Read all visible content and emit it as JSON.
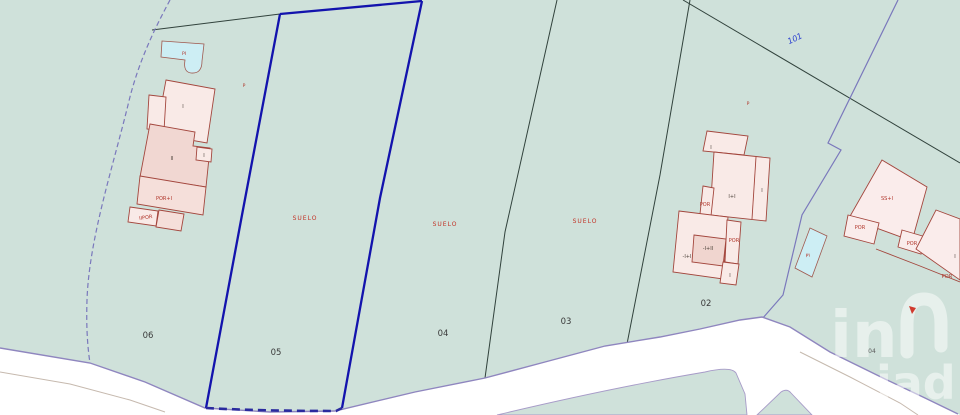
{
  "map": {
    "parcels": [
      "06",
      "05",
      "04",
      "03",
      "02"
    ],
    "suelo": [
      "SUELO",
      "SUELO",
      "SUELO"
    ],
    "road_ref": "101",
    "adjacent_parcel_ref": "04",
    "markers": {
      "p_left": "P",
      "p_right": "P",
      "pool_left": "PI",
      "pool_right": "PI"
    },
    "building_left": {
      "floor_i": "I",
      "floor_ii": "II",
      "annex_i": "I",
      "por_i": "POR+I",
      "iipor": "IIPOR"
    },
    "building_center": {
      "top_i": "I",
      "i_plus_i": "I+I",
      "right_i": "I",
      "por_left": "POR",
      "minus_i_plus_ii": "-I+II",
      "por_right": "POR",
      "minus_i_plus_i": "-I+I",
      "bottom_i": "I"
    },
    "building_right": {
      "ss_i": "SS+I",
      "por_a": "POR",
      "por_b": "POR",
      "part_i": "I",
      "por_c": "POR"
    },
    "watermark": {
      "logo": "in",
      "text": "iad"
    },
    "colors": {
      "background": "#cfe1da",
      "highlight_blue": "#1313ad",
      "building_fill": "#f9eae7",
      "building_fill_dark": "#f1d7d2",
      "building_stroke": "#a3463d",
      "pool_fill": "#cdeef4",
      "suelo_text": "#c23327",
      "boundary_dark": "#31423c",
      "boundary_purple": "#7a78bc",
      "road_edge": "#8f86bf"
    }
  }
}
